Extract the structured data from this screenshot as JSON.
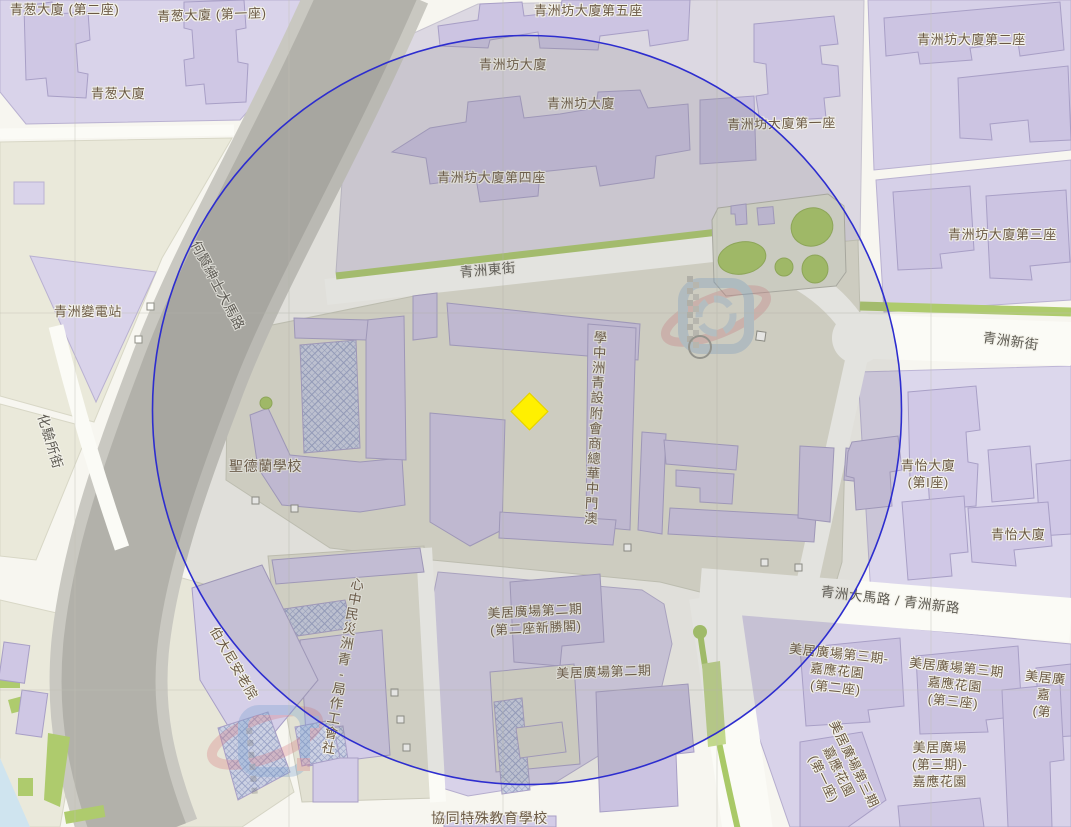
{
  "labels": {
    "cheng_chong_2": "青葱大廈 (第二座)",
    "cheng_chong_1": "青葱大廈 (第一座)",
    "cheng_chong": "青葱大廈",
    "cheok_van_5": "青洲坊大廈第五座",
    "cheok_van_a": "青洲坊大廈",
    "cheok_van_b": "青洲坊大廈",
    "cheok_van_4": "青洲坊大廈第四座",
    "cheok_van_2": "青洲坊大廈第二座",
    "cheok_van_1": "青洲坊大廈第一座",
    "cheok_van_3": "青洲坊大廈第三座",
    "substation": "青洲變電站",
    "st_teresa": "聖德蘭學校",
    "school_vertical": "澳門中華總商會附設青洲中學",
    "ias_vertical": "社會工作局-青洲災民中心",
    "bethany": "伯大尼安老院",
    "cheng_i_block1": [
      "青怡大廈",
      "(第I座)"
    ],
    "cheng_i": "青怡大廈",
    "mei_2_tower": [
      "美居廣場第二期",
      "(第二座新勝閣)"
    ],
    "mei_2": "美居廣場第二期",
    "mei_3_block2": [
      "美居廣場第三期-",
      "嘉應花園",
      "(第二座)"
    ],
    "mei_3_block3": [
      "美居廣場第三期",
      "嘉應花園",
      "(第三座)"
    ],
    "mei_3_edge": [
      "美居廣",
      "嘉",
      "(第"
    ],
    "mei_3_main": [
      "美居廣場",
      "(第三期)-",
      "嘉應花園"
    ],
    "mei_3_block1": [
      "美居廣場第三期",
      "嘉應花園",
      "(第一座)"
    ],
    "hin_tong": "協同特殊教育學校"
  },
  "roads": {
    "ho_yin": "何賢紳士大馬路",
    "fa_yim": "化驗所街",
    "east_street": "青洲東街",
    "new_street": "青洲新街",
    "main_road": "青洲大馬路 / 青洲新路"
  },
  "marker": {
    "type": "diamond",
    "color": "#FFF000"
  },
  "circle_overlay": {
    "stroke_color": "#2D2DCF",
    "fill_tint": "rgba(110,110,110,0.17)"
  },
  "colors": {
    "building_fill": "#CFC7E4",
    "parcel_lavender": "#D8D2E9",
    "parcel_cream": "#EAE9DA",
    "road_grey": "#B2B1AA",
    "green": "#AECB6D",
    "water": "#CFE4EF",
    "hatch_line": "#9AA3C6"
  }
}
